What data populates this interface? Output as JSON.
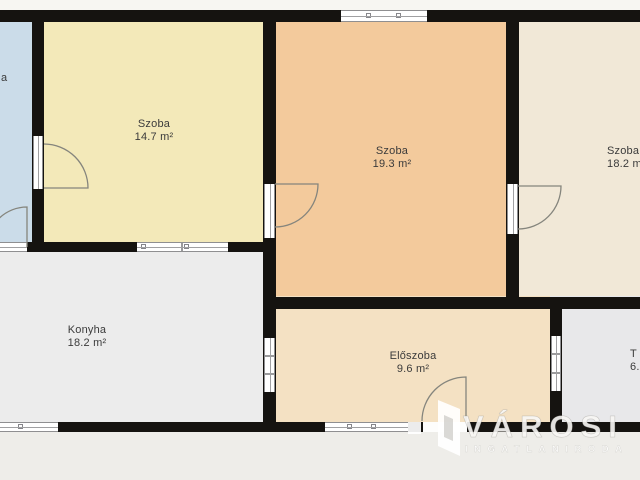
{
  "floorplan": {
    "rooms": [
      {
        "id": "szoba-1",
        "name": "Szoba",
        "area": "14.7 m²",
        "color": "#f3e9b9"
      },
      {
        "id": "szoba-2",
        "name": "Szoba",
        "area": "19.3 m²",
        "color": "#f3ca9c"
      },
      {
        "id": "szoba-3",
        "name": "Szoba",
        "area": "18.2 m²",
        "color": "#f1e8d7"
      },
      {
        "id": "konyha",
        "name": "Konyha",
        "area": "18.2 m²",
        "color": "#ececec"
      },
      {
        "id": "eloszoba",
        "name": "Előszoba",
        "area": "9.6 m²",
        "color": "#f4e1c3"
      },
      {
        "id": "storage-partial",
        "name": "T",
        "area": "6.",
        "color": "#e8e8ea"
      },
      {
        "id": "blue-partial",
        "name": "a",
        "area": "",
        "color": "#cbdce9"
      }
    ],
    "watermark": {
      "brand": "VÁROSI",
      "tagline": "INGATLANIRODA"
    },
    "colors": {
      "wall": "#151310",
      "background": "#eeede9",
      "label_text": "#3b3b3b",
      "window_frame": "#8f8f91"
    }
  }
}
